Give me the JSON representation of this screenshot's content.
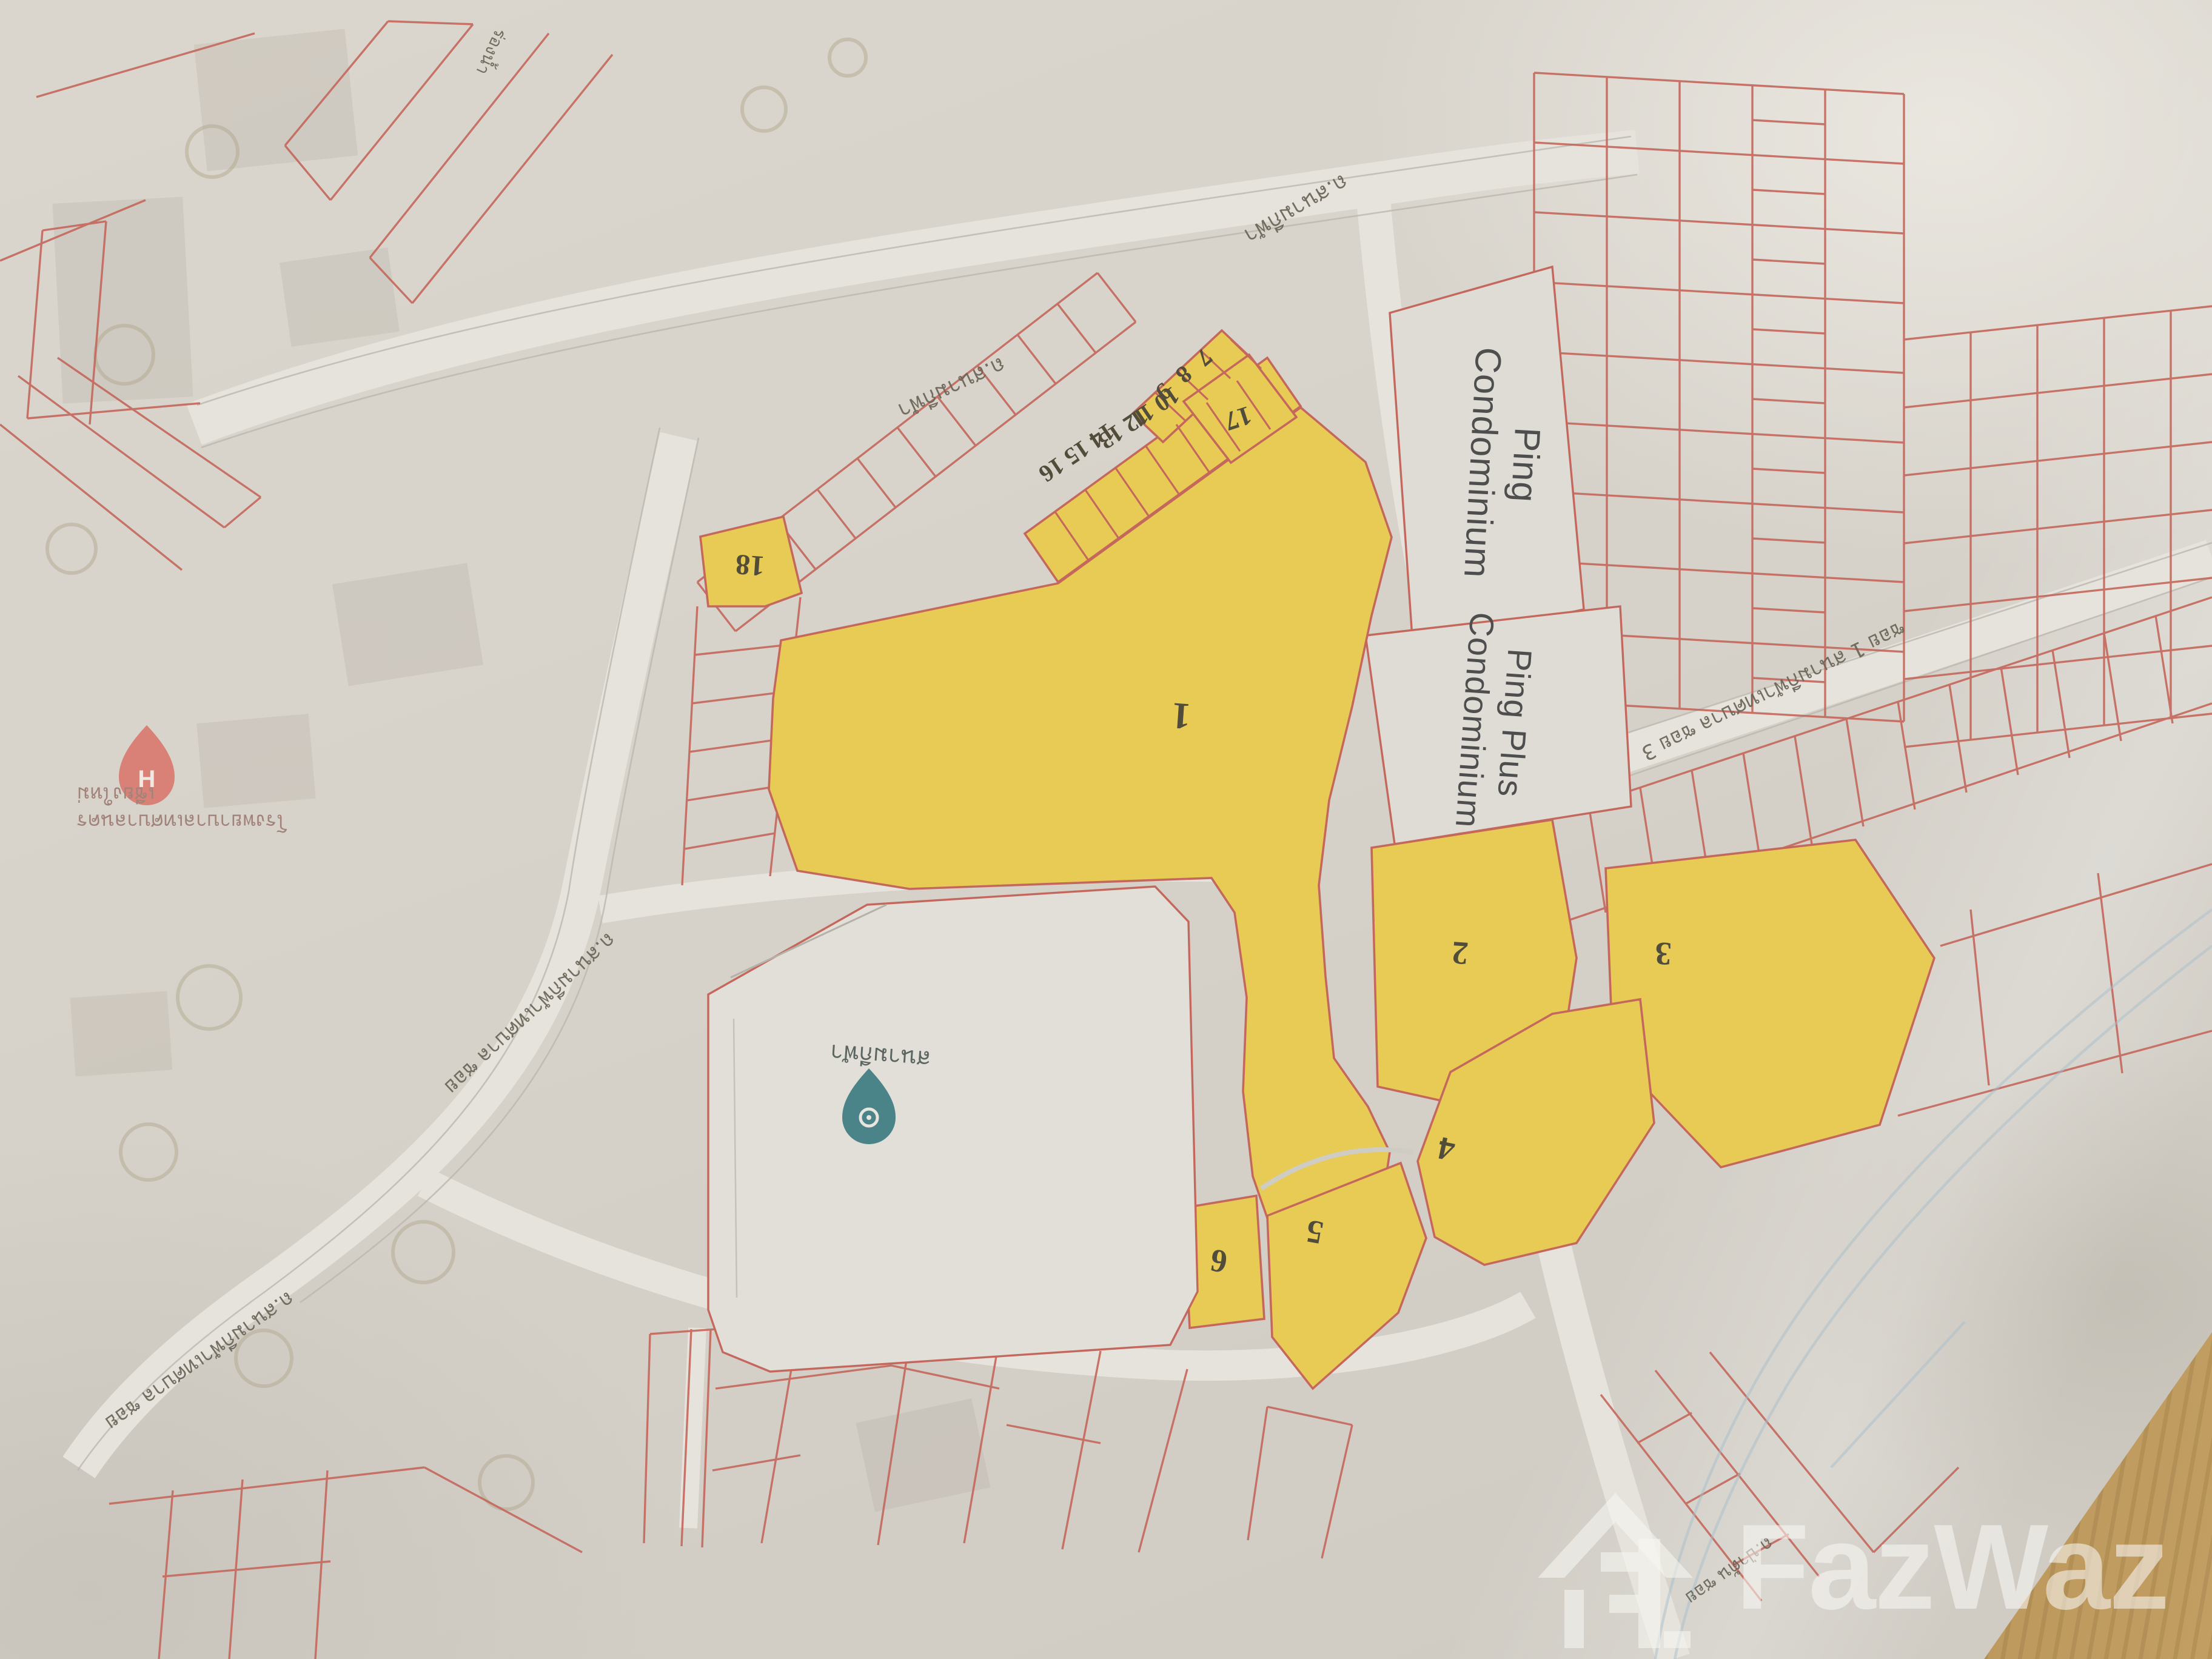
{
  "map": {
    "watermark": {
      "brand": "FazWaz"
    },
    "condos": {
      "ping": {
        "line1": "Ping",
        "line2": "Condominium"
      },
      "ping_plus": {
        "line1": "Ping Plus",
        "line2": "Condominium"
      }
    },
    "plots": {
      "p1": "1",
      "p2": "2",
      "p3": "3",
      "p4": "4",
      "p5": "5",
      "p6": "6",
      "p17": "17",
      "p18": "18",
      "s789": "7 8 9",
      "s1011": "10 11",
      "s1213": "12 13",
      "s141516": "14 15 16"
    },
    "roads": {
      "top_a": "ถ.สนามกีฬา",
      "top_b": "ถ.สนามกีฬา",
      "left_a": "ถ.สนามกีฬาเทศบาล ซอย",
      "left_b": "ถ.สนามกีฬาเทศบาล ซอย",
      "mid_right": "ซอย 1 สนามกีฬาเทศบาล ซอย 3",
      "bottom_right": "ถ.ป่าตัน ซอย",
      "canal": "ร่องน้ำ"
    },
    "pois": {
      "stadium": {
        "label": "สนามกีฬา"
      },
      "hospital": {
        "line1": "โรงพยาบาลเทศบาลนคร",
        "line2": "เชียงใหม่"
      }
    },
    "colors": {
      "parcel_line": "#c4675c",
      "highlight_parcel": "#e8cb55",
      "paper": "#d6d2ca",
      "wood": "#c29e62",
      "hospital_pin": "#d98176",
      "poi_pin": "#4a8489",
      "watermark": "rgba(248,247,243,0.58)"
    }
  }
}
